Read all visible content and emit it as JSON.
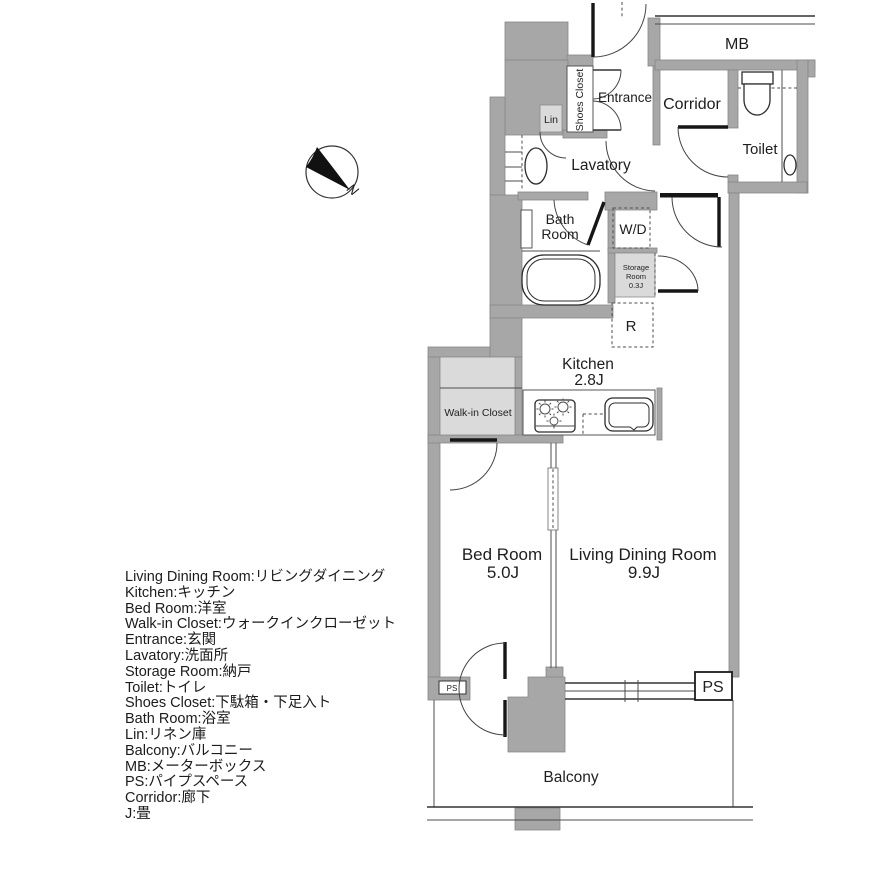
{
  "compass": {
    "north_label": "N"
  },
  "rooms": {
    "mb": "MB",
    "entrance": "Entrance",
    "corridor": "Corridor",
    "toilet": "Toilet",
    "shoes_closet": "Shoes Closet",
    "lin": "Lin",
    "lavatory": "Lavatory",
    "bath_line1": "Bath",
    "bath_line2": "Room",
    "wd": "W/D",
    "storage_line1": "Storage",
    "storage_line2": "Room",
    "storage_line3": "0.3J",
    "refrigerator": "R",
    "kitchen": "Kitchen",
    "kitchen_size": "2.8J",
    "walk_in_closet": "Walk-in Closet",
    "bed_room": "Bed Room",
    "bed_room_size": "5.0J",
    "living_dining": "Living Dining Room",
    "living_dining_size": "9.9J",
    "balcony": "Balcony",
    "ps_small": "PS",
    "ps_large": "PS"
  },
  "legend": {
    "lines": [
      "Living Dining Room:リビングダイニング",
      "Kitchen:キッチン",
      "Bed Room:洋室",
      "Walk-in Closet:ウォークインクローゼット",
      "Entrance:玄関",
      "Lavatory:洗面所",
      "Storage Room:納戸",
      "Toilet:トイレ",
      "Shoes Closet:下駄箱・下足入ト",
      "Bath Room:浴室",
      "Lin:リネン庫",
      "Balcony:バルコニー",
      "MB:メーターボックス",
      "PS:パイプスペース",
      "Corridor:廊下",
      "J:畳"
    ]
  }
}
